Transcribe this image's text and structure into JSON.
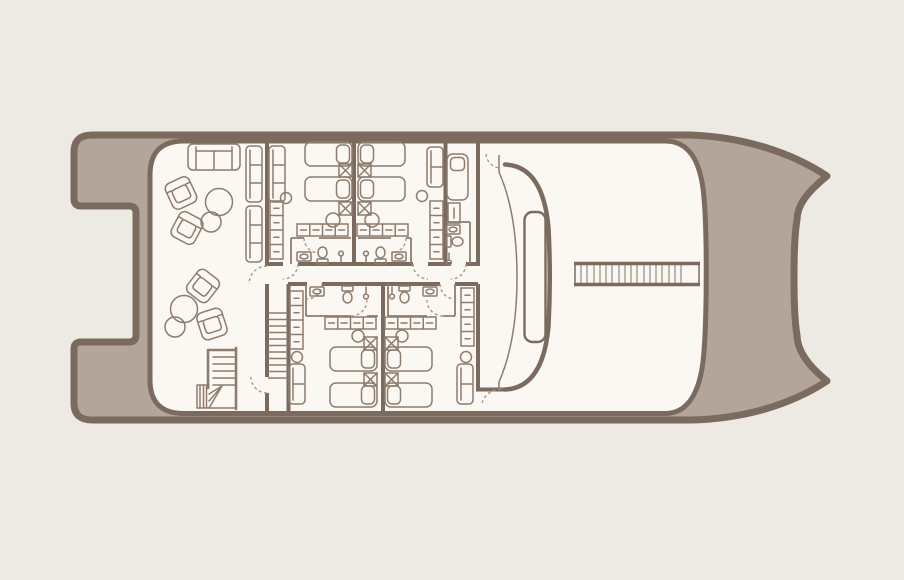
{
  "palette": {
    "background": "#edeae3",
    "deck": "#b3a59b",
    "outline": "#7b6a5e",
    "wall": "#7b6a5e",
    "interior": "#fbf7f2",
    "furniture": "#8e7c6e",
    "door_arc": "#a4937f",
    "ladder_rung": "#a79a8d"
  },
  "plan": {
    "kind": "catamaran-yacht-deck-floor-plan",
    "areas": [
      {
        "name": "salon-lounge",
        "furniture": {
          "sofa": 1,
          "settee": 2,
          "armchair": 4,
          "round_table": 4,
          "l_staircase": 1
        }
      },
      {
        "name": "guest-cabin-fore-port",
        "furniture": {
          "twin_bed": 2,
          "nightstand": 2,
          "stool": 2,
          "wardrobe_row": 1,
          "closet_column": 1,
          "settee": 1,
          "bathroom": 1
        }
      },
      {
        "name": "guest-cabin-fore-starboard",
        "furniture": {
          "twin_bed": 2,
          "nightstand": 2,
          "stool": 2,
          "wardrobe_row": 1,
          "closet_column": 1,
          "settee": 1,
          "bathroom": 1
        }
      },
      {
        "name": "single-cabin-fore",
        "furniture": {
          "single_bed": 1,
          "cabinet": 1,
          "bathroom": 1
        }
      },
      {
        "name": "guest-cabin-aft-port",
        "furniture": {
          "twin_bed": 2,
          "nightstand": 2,
          "stool": 2,
          "wardrobe_row": 1,
          "closet_column": 1,
          "settee": 1,
          "bathroom": 1
        }
      },
      {
        "name": "guest-cabin-aft-starboard",
        "furniture": {
          "twin_bed": 2,
          "nightstand": 2,
          "stool": 2,
          "wardrobe_row": 1,
          "closet_column": 1,
          "settee": 1,
          "bathroom": 1
        }
      },
      {
        "name": "central-corridor",
        "furniture": {
          "staircase": 1
        }
      },
      {
        "name": "side-passage",
        "furniture": {}
      },
      {
        "name": "foredeck",
        "furniture": {
          "gangway": 1
        }
      }
    ],
    "features": [
      "twin-stern-swim-platforms",
      "stern-notch",
      "twin-bow-tips",
      "curved-windshield",
      "windshield-window-panel",
      "bow-gangway-catwalk"
    ],
    "gangway": {
      "rungs": 17
    },
    "bathroom_fixtures": [
      "sink",
      "toilet",
      "shower"
    ]
  }
}
